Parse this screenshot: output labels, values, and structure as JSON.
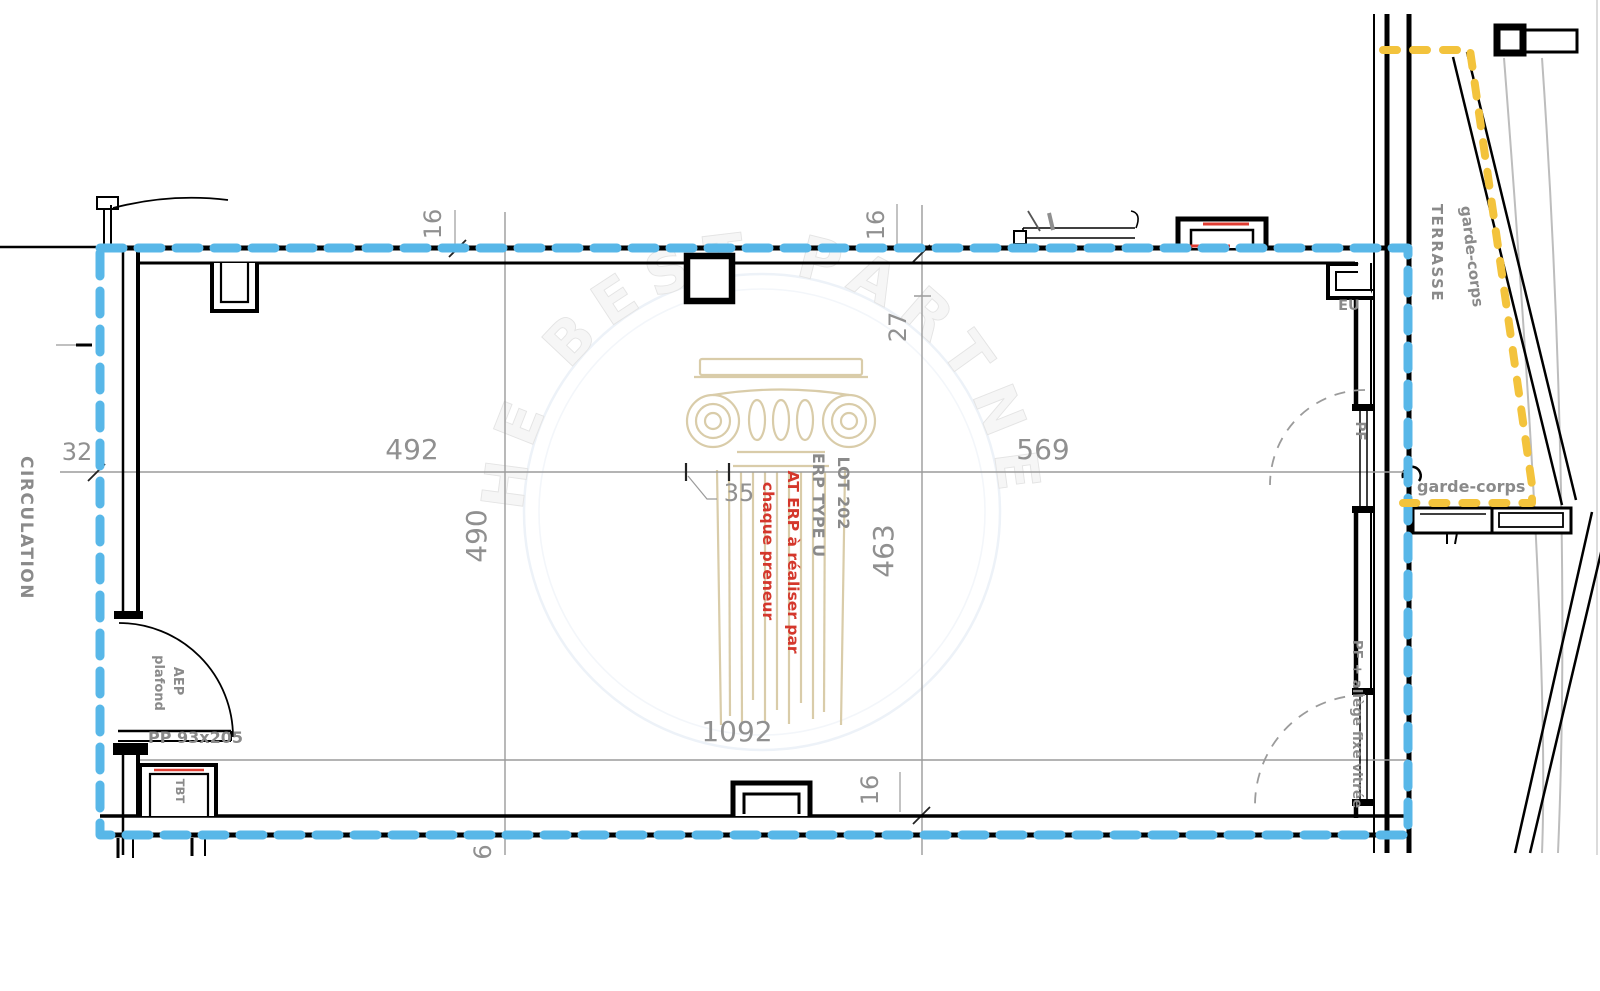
{
  "areas": {
    "circulation": "CIRCULATION",
    "terrasse": "TERRASSE"
  },
  "unit": {
    "lot": "LOT 202",
    "erp_type": "ERP TYPE U",
    "note_line1": "AT ERP à réaliser par",
    "note_line2": "chaque preneur"
  },
  "labels": {
    "eu": "EU",
    "tbt": "TBT",
    "pf_window": "PF",
    "pf_allege_window": "PF + allège fixe vitrée",
    "aep": "AEP",
    "aep_plafond": "plafond",
    "door_size": "PP 93x205",
    "garde_corps_diagonal": "garde-corps",
    "garde_corps_horizontal": "garde-corps"
  },
  "dimensions": {
    "top_left_width": "492",
    "top_right_width": "569",
    "left_height": "490",
    "right_height": "463",
    "bottom_width": "1092",
    "circulation_width": "32",
    "pillar_width": "35",
    "right_offset": "27",
    "wall_top": "16",
    "wall_right": "16",
    "wall_bottom": "16",
    "bottom_partial": "6"
  },
  "watermark": {
    "arc_text": "THE BEST PARTNER"
  },
  "colors": {
    "boundary_blue": "#58b7e8",
    "garde_corps_yellow": "#f3c33c",
    "accent_red": "#e03c31",
    "note_red": "#d4372c",
    "dim_gray": "#909090",
    "watermark_tan": "#d9cca9"
  }
}
